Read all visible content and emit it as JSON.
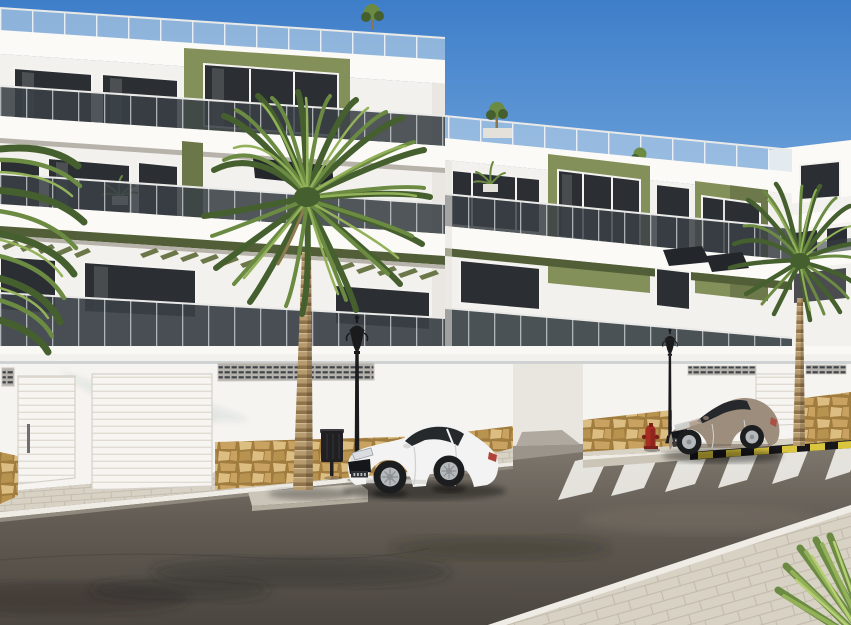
{
  "scene": {
    "description": "Sunny photorealistic render of a modern Mediterranean apartment complex: white three-storey buildings with olive-green accent panels and glass balconies, street-level white garage doors over a sandstone base wall, a large palm tree on a traffic island, a white coupe and a bronze coupe parked at the curb, a zebra crossing, black street lamps, a litter bin and a red fire hydrant under a clear blue sky",
    "objects": [
      "apartment-building-left",
      "apartment-building-right",
      "distant-building",
      "roof-terrace-glass-railings",
      "olive-accent-panels",
      "balcony-bands",
      "pergola-louvres",
      "street-wall-with-garage-doors",
      "ventilation-grilles",
      "sandstone-wall-base",
      "sidewalk",
      "traffic-island",
      "asphalt-road",
      "zebra-crossing",
      "yellow-black-curb-marking",
      "white-coupe-car",
      "bronze-coupe-car",
      "street-lamp-near",
      "street-lamp-far",
      "litter-bin",
      "fire-hydrant",
      "large-palm-tree",
      "right-palm-tree",
      "foreground-palm-leaves-top-left",
      "foreground-palm-leaves-bottom-right",
      "rooftop-plants",
      "balcony-plants"
    ]
  },
  "colors": {
    "sky_top": "#3e7ec9",
    "sky_mid": "#6aa0da",
    "sky_low": "#9fc3e8",
    "sky_horizon": "#cfe2f3",
    "facade_white": "#f3f1ed",
    "facade_bright": "#fbfaf7",
    "facade_shade": "#e4e1da",
    "facade_deep_shade": "#cfccc5",
    "fascia_underside": "#b7b3ab",
    "olive": "#84905a",
    "olive_dark": "#6b7748",
    "olive_deep": "#525e37",
    "window_glass": "#2b2f33",
    "window_glass_light": "#454c52",
    "window_frame": "#f4f3f0",
    "balcony_glass": "#394045",
    "balcony_rail": "#e9e9e7",
    "roof_glass": "#ccdce9",
    "pergola_dark": "#23262b",
    "wall_white": "#f6f4f0",
    "wall_shade": "#e9e6e0",
    "molding": "#faf8f4",
    "garage_door": "#f7f5f1",
    "garage_line": "#e0dcd4",
    "door_handle": "#6f6f6f",
    "vent_dark": "#41444a",
    "vent_frame": "#b5b2ac",
    "stone_base": "#c9a261",
    "stone_dark": "#a17c3f",
    "stone_light": "#dcbd82",
    "stone_mid": "#b8924f",
    "paver": "#d8d2c5",
    "paver_line": "#c2bbad",
    "curb_white": "#efece5",
    "curb_concrete": "#cbc5b8",
    "road_top": "#8a8379",
    "road_mid": "#625c54",
    "road_bottom": "#4b463f",
    "road_stain": "#2f2b26",
    "crosswalk": "#efede7",
    "curb_yellow": "#d9c53e",
    "curb_black": "#17171a",
    "lamp_black": "#1b1b1d",
    "bin_dark": "#202023",
    "bin_light": "#3c3c40",
    "hydrant_red": "#a62d22",
    "hydrant_dark": "#7c1f18",
    "car_white": "#f2f3f2",
    "car_white_shade": "#d7d8d6",
    "car_glass": "#26292c",
    "car_grille": "#151619",
    "tire": "#1c1d1f",
    "rim": "#b6b9bb",
    "hub": "#8e9193",
    "car_bronze": "#9d8d7c",
    "car_bronze_dark": "#7c6e60",
    "car_bronze_light": "#bcae9e",
    "taillight": "#b04238",
    "palm_trunk": "#b79b6e",
    "palm_trunk_band": "#8f734a",
    "palm_trunk_light": "#d6bf97",
    "frond_dark": "#45602e",
    "frond_mid": "#6b8a42",
    "frond_light": "#92b158",
    "frond_pale": "#b6cf74",
    "frond_dead": "#8d7c50"
  }
}
